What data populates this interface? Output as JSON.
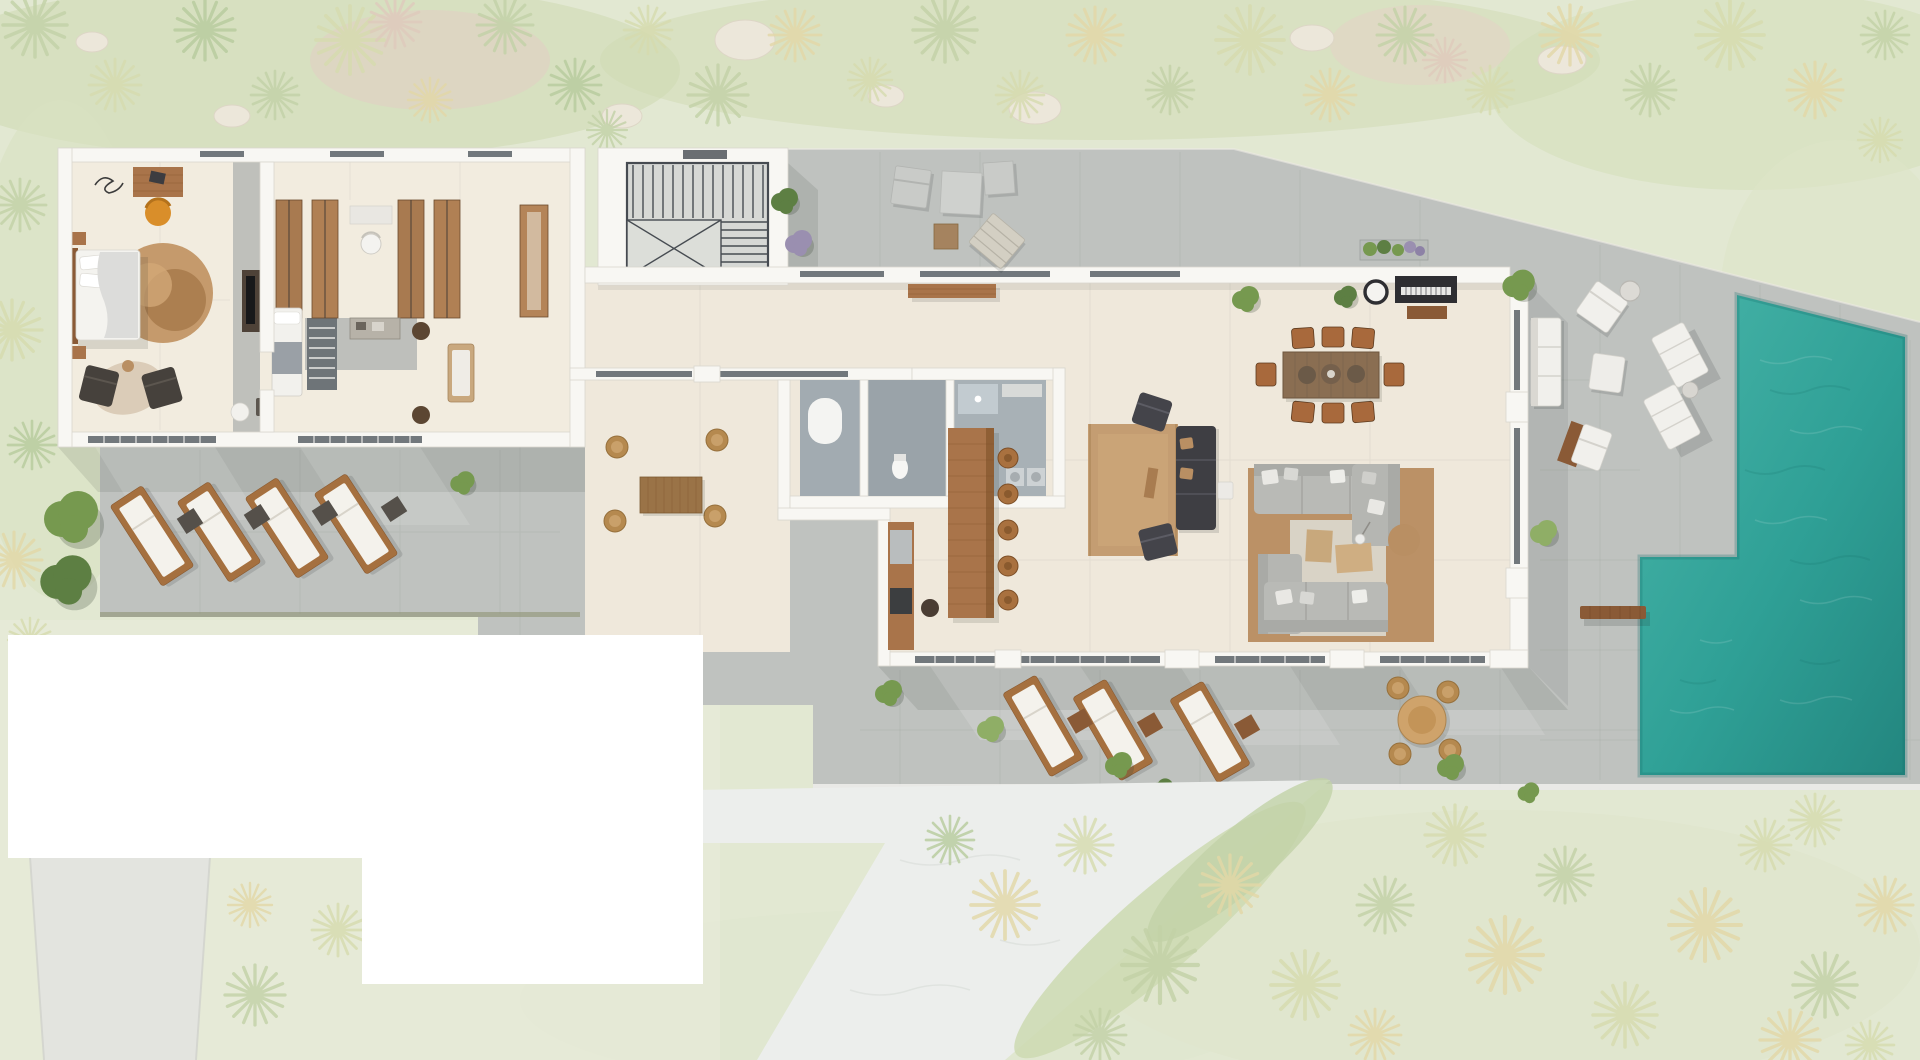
{
  "scene": {
    "kind": "architectural-floor-plan-render",
    "view": "top-down",
    "canvas": {
      "width": 1920,
      "height": 1060
    },
    "areas": [
      "landscaped-garden",
      "master-bedroom",
      "walk-in-closet",
      "staircase",
      "corridor",
      "bathroom-block",
      "kitchen",
      "living-room",
      "dining-area",
      "piano-corner",
      "left-lounger-terrace",
      "courtyard-terrace",
      "upper-terrace",
      "south-terrace",
      "pool-deck",
      "swimming-pool",
      "access-road",
      "sandy-path",
      "masked-white-areas"
    ]
  },
  "colors": {
    "grass": "#e2e8d2",
    "grassBand": "#ccd8ae",
    "grassWash": "#e9ecdc",
    "rock": "#ece7da",
    "palmA": "#c2d1a6",
    "palmB": "#d6dbae",
    "palmC": "#e2d7a6",
    "palmD": "#dfc9bb",
    "palmE": "#b6cb9c",
    "treeDark": "#5d7f43",
    "treeMid": "#76994f",
    "treeLight": "#8fae66",
    "deck": "#bfc2bf",
    "deckEdge": "#ededea",
    "floor": "#efe8db",
    "floorBedroom": "#f2ecdf",
    "wall": "#f8f7f3",
    "wallEdge": "#d9d6cf",
    "glass": "#5b6166",
    "roomFloor": "#a2abb1",
    "wood": "#a9744a",
    "woodDark": "#8a5a36",
    "woodLight": "#c8a87c",
    "furnWhite": "#f1f0ec",
    "sofaGray": "#b9bab6",
    "sofaGrayDark": "#a9aaa6",
    "rugTan": "#bb9166",
    "rugLight": "#cfa87c",
    "matLight": "#d9d3c6",
    "darkFurn": "#3e3e43",
    "orange": "#d98e2a",
    "clay": "#a9713f",
    "pool1": "#49b5a9",
    "pool2": "#2fa096",
    "pool3": "#23867f",
    "poolEdge": "#17706a",
    "white": "#ffffff",
    "road": "#e3e4df",
    "path": "#eceeec",
    "stairFrame": "#464b51",
    "stairFloor": "#d6d8d5"
  },
  "objects": {
    "master_bedroom": {
      "bed": 1,
      "round_rug": 1,
      "desk": 1,
      "desk_chair": 1,
      "armchairs": 2,
      "tv_console": 1,
      "nightstands": 2,
      "cowhide_rug": 1
    },
    "walk_in_closet": {
      "wardrobes": 4,
      "vanity": 1,
      "vanity_stool": 1,
      "daybed": 1,
      "dresser": 1,
      "baskets": 2,
      "bench": 1,
      "striped_runner": 1
    },
    "staircase": {
      "flights": 1,
      "landing": 1
    },
    "kitchen": {
      "island": 1,
      "bar_stools": 5,
      "cabinet_run": 1,
      "back_rooms": 3
    },
    "dining_area": {
      "table": 1,
      "chairs": 8,
      "bowls": 3
    },
    "piano_corner": {
      "piano": 1,
      "piano_bench": 1,
      "wall_mirror": 1,
      "planter": 1
    },
    "tv_lounge": {
      "rug": 1,
      "dark_sofa": 1,
      "dark_armchairs": 2,
      "side_table": 1
    },
    "living_room": {
      "sectional_pieces": 4,
      "coffee_tables": 2,
      "ottoman": 1,
      "floor_lamp": 1
    },
    "left_terrace": {
      "sun_loungers": 4,
      "side_tables": 4
    },
    "courtyard_terrace": {
      "outdoor_dining_table": 1,
      "wicker_chairs": 4
    },
    "upper_terrace": {
      "outdoor_chairs": 2,
      "outdoor_table": 1,
      "cube_stool": 2,
      "woven_lounger": 1,
      "bench": 1
    },
    "south_terrace": {
      "sun_loungers": 3,
      "round_dining_table": 1,
      "wicker_chairs": 4
    },
    "pool_deck": {
      "outdoor_sofa": 1,
      "armchairs": 2,
      "sun_loungers": 2,
      "pouf": 1,
      "beach_ball": 1,
      "side_tables": 2
    },
    "pool": {
      "basins": 1,
      "l_extension": 1,
      "wood_bench": 1
    },
    "masked_white_rectangles": 2,
    "access_road": 1,
    "sandy_path": 1
  }
}
